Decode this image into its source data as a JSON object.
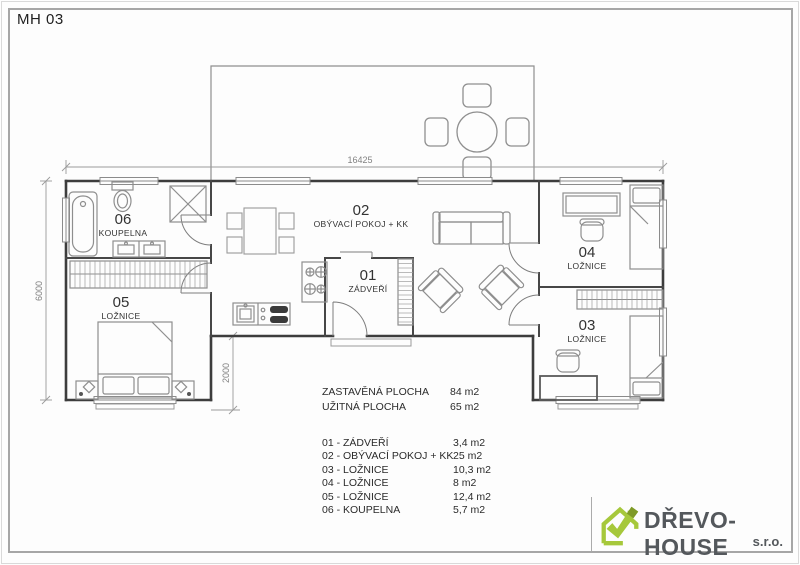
{
  "page": {
    "title": "MH 03"
  },
  "plan": {
    "dim_top": "16425",
    "dim_left": "6000",
    "dim_porch": "2000",
    "rooms": {
      "r01": {
        "num": "01",
        "name": "ZÁDVEŘÍ"
      },
      "r02": {
        "num": "02",
        "name": "OBÝVACÍ POKOJ + KK"
      },
      "r03": {
        "num": "03",
        "name": "LOŽNICE"
      },
      "r04": {
        "num": "04",
        "name": "LOŽNICE"
      },
      "r05": {
        "num": "05",
        "name": "LOŽNICE"
      },
      "r06": {
        "num": "06",
        "name": "KOUPELNA"
      }
    }
  },
  "summary": [
    {
      "label": "ZASTAVĚNÁ PLOCHA",
      "value": "84 m2"
    },
    {
      "label": "UŽITNÁ PLOCHA",
      "value": "65 m2"
    }
  ],
  "legend": [
    {
      "label": "01 -  ZÁDVEŘÍ",
      "value": "3,4 m2"
    },
    {
      "label": "02 -  OBÝVACÍ POKOJ + KK",
      "value": "25 m2"
    },
    {
      "label": "03 -  LOŽNICE",
      "value": "10,3 m2"
    },
    {
      "label": "04 -  LOŽNICE",
      "value": "8 m2"
    },
    {
      "label": "05 -  LOŽNICE",
      "value": "12,4 m2"
    },
    {
      "label": "06 -  KOUPELNA",
      "value": "5,7 m2"
    }
  ],
  "logo": {
    "name": "DŘEVO-HOUSE",
    "suffix": "s.r.o.",
    "icon": "house-check-icon",
    "green": "#a6c83b",
    "green_dark": "#7e9a28",
    "text_color": "#54585c"
  }
}
